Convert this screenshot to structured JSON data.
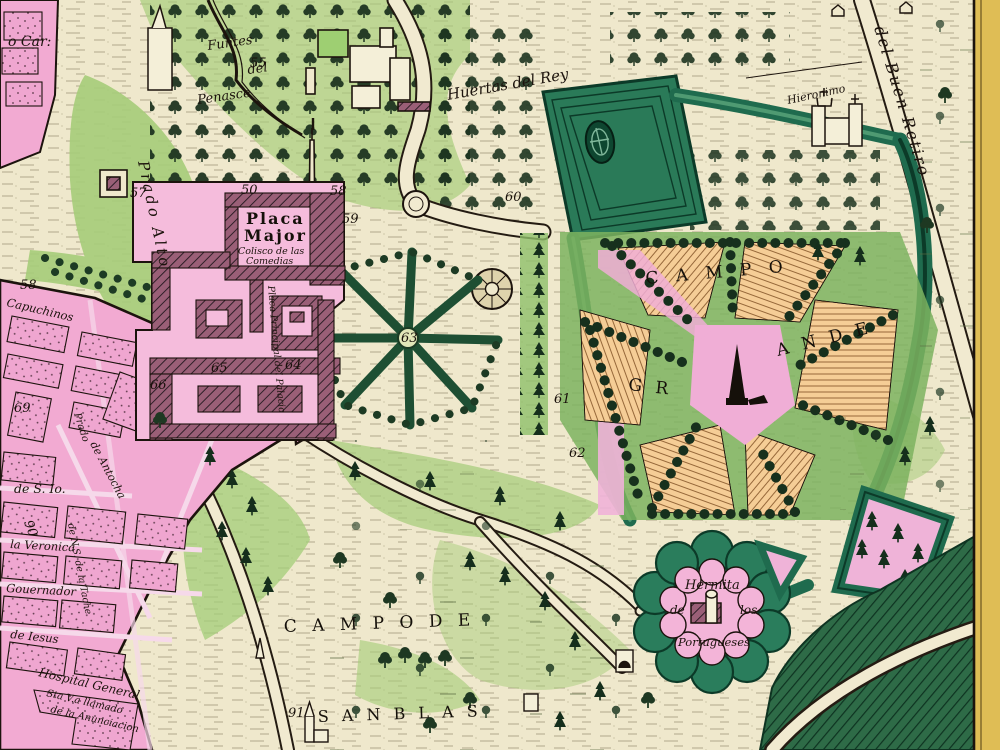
{
  "map": {
    "type": "antique-engraved-city-map",
    "region": "Buen Retiro and surroundings, Madrid",
    "labels": {
      "o_car": "o Car:",
      "fuentes_1": "Funtes",
      "fuentes_2": "del",
      "fuentes_3": "Penasce",
      "huertas_del_rey": "Huertas del Rey",
      "buen_retiro_road": "del Buen Retiro",
      "hieronimo": "Hieronimo",
      "prado_alto": "Prado Alto",
      "placa_major_1": "Placa",
      "placa_major_2": "Major",
      "coliseo_1": "Colisco de las",
      "coliseo_2": "Comedias",
      "placa_principal": "Placa Principal del Palacio",
      "campo": "C A M P O",
      "grande_1": "G R",
      "grande_2": "A N D E",
      "hermita_1": "Hermita",
      "hermita_2": "de",
      "hermita_3": "los",
      "hermita_4": "Portugueses",
      "campo_de": "C A M P O   D E",
      "san_blas": "S A N  B L A S",
      "capuchinos": "Capuchinos",
      "de_s_io": "de S. Io.",
      "la_veronica": "la Veronica",
      "gouernador": "Gouernador",
      "de_iesus": "de Iesus",
      "hospital_1": "Hospital General",
      "hospital_2": "Sta V.a llamado",
      "hospital_3": "de la Anunciacion",
      "antocha": "de Antocha",
      "tache": "de N.S. de la Tache",
      "prado_st": "Prado"
    },
    "numbers": {
      "n50": "50",
      "n55": "55",
      "n57": "57",
      "n58": "58",
      "n58b": "58",
      "n59": "59",
      "n60": "60",
      "n61": "61",
      "n62": "62",
      "n63": "63",
      "n64": "64",
      "n65": "65",
      "n66": "66",
      "n69": "69",
      "n90": "90",
      "n91": "91"
    },
    "colors": {
      "parchment": "#efe8cc",
      "city_pink": "#f2aad2",
      "palace_pink": "#f5bcdc",
      "light_green": "#a5cc79",
      "hedge_green": "#1f6b4e",
      "field_orange": "#f5cd96",
      "margin_yellow": "#dfbd55",
      "ink": "#1c130d"
    }
  }
}
